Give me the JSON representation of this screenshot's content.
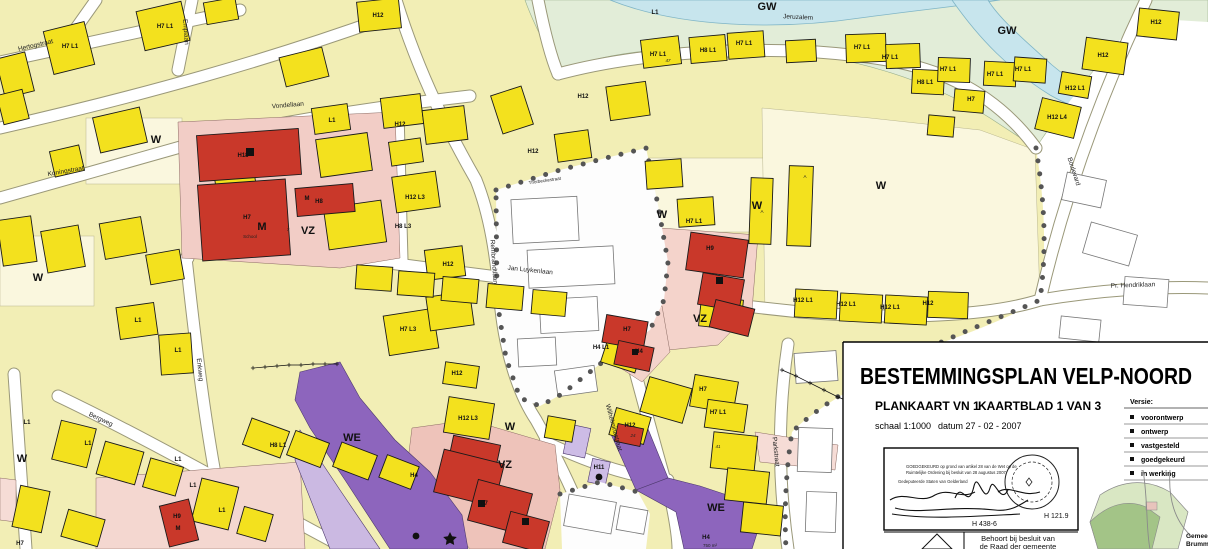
{
  "title_block": {
    "title": "BESTEMMINGSPLAN VELP-NOORD",
    "sheet_label": "PLANKAART VN 1",
    "sheet_number": "KAARTBLAD 1 VAN 3",
    "scale": "schaal 1:1000",
    "date": "datum 27 - 02 - 2007",
    "versions_title": "Versie:",
    "versions": [
      "voorontwerp",
      "ontwerp",
      "vastgesteld",
      "goedgekeurd",
      "in werking"
    ],
    "approval_stamp": {
      "line1": "GOEDGEKEURD op grond van artikel 28 van de Wet op de",
      "line2": "Ruimtelijke Ordening bij besluit van 28 augustus 2007",
      "line3": "Gedeputeerde Staten van Gelderland",
      "ref_left": "H 438-6",
      "ref_right": "H 121.9"
    },
    "council_note_line1": "Behoort bij besluit van",
    "council_note_line2": "de Raad der gemeente",
    "inset_caption_line1": "Gemeente",
    "inset_caption_line2": "Brummen"
  },
  "map": {
    "labels": [
      {
        "t": "W",
        "x": 156,
        "y": 143,
        "k": "zone"
      },
      {
        "t": "W",
        "x": 38,
        "y": 281,
        "k": "zone"
      },
      {
        "t": "W",
        "x": 662,
        "y": 218,
        "k": "zone"
      },
      {
        "t": "W",
        "x": 881,
        "y": 189,
        "k": "zone"
      },
      {
        "t": "W",
        "x": 757,
        "y": 209,
        "k": "zone"
      },
      {
        "t": "W",
        "x": 22,
        "y": 462,
        "k": "zone"
      },
      {
        "t": "W",
        "x": 510,
        "y": 430,
        "k": "zone"
      },
      {
        "t": "VZ",
        "x": 308,
        "y": 234,
        "k": "zone"
      },
      {
        "t": "VZ",
        "x": 700,
        "y": 322,
        "k": "zone"
      },
      {
        "t": "VZ",
        "x": 505,
        "y": 468,
        "k": "zone"
      },
      {
        "t": "WE",
        "x": 352,
        "y": 441,
        "k": "zone"
      },
      {
        "t": "WE",
        "x": 716,
        "y": 511,
        "k": "zone"
      },
      {
        "t": "GW",
        "x": 767,
        "y": 10,
        "k": "zone"
      },
      {
        "t": "GW",
        "x": 1007,
        "y": 34,
        "k": "zone"
      },
      {
        "t": "M",
        "x": 262,
        "y": 230,
        "k": "zone"
      },
      {
        "t": "M",
        "x": 307,
        "y": 200,
        "k": "bldg"
      },
      {
        "t": "M",
        "x": 178,
        "y": 530,
        "k": "bldg"
      },
      {
        "t": "H18",
        "x": 243,
        "y": 157,
        "k": "bldg"
      },
      {
        "t": "H7",
        "x": 247,
        "y": 219,
        "k": "bldg"
      },
      {
        "t": "H8",
        "x": 319,
        "y": 203,
        "k": "bldg"
      },
      {
        "t": "H9",
        "x": 710,
        "y": 250,
        "k": "bldg"
      },
      {
        "t": "H9",
        "x": 177,
        "y": 518,
        "k": "bldg"
      },
      {
        "t": "H7",
        "x": 627,
        "y": 331,
        "k": "bldg"
      },
      {
        "t": "H4",
        "x": 639,
        "y": 353,
        "k": "bldg"
      },
      {
        "t": "H7",
        "x": 484,
        "y": 505,
        "k": "bldg"
      },
      {
        "t": "H4",
        "x": 414,
        "y": 477,
        "k": "bldg"
      },
      {
        "t": "H4",
        "x": 706,
        "y": 539,
        "k": "bldg"
      },
      {
        "t": "H11",
        "x": 599,
        "y": 469,
        "k": "bldg"
      },
      {
        "t": "H4 L1",
        "x": 601,
        "y": 349,
        "k": "bldg"
      },
      {
        "t": "School",
        "x": 250,
        "y": 238,
        "k": "tiny"
      },
      {
        "t": "750 m²",
        "x": 710,
        "y": 547,
        "k": "tiny"
      },
      {
        "t": "Hertogstraat",
        "x": 36,
        "y": 47,
        "r": -13,
        "k": "street"
      },
      {
        "t": "Koningstraat",
        "x": 66,
        "y": 173,
        "r": -10,
        "k": "street"
      },
      {
        "t": "Vondellaan",
        "x": 288,
        "y": 107,
        "r": -5,
        "k": "street"
      },
      {
        "t": "Emplaan",
        "x": 184,
        "y": 32,
        "r": 86,
        "k": "street"
      },
      {
        "t": "Jeruzalem",
        "x": 798,
        "y": 19,
        "r": 3,
        "k": "street"
      },
      {
        "t": "Jan Luykenlaan",
        "x": 530,
        "y": 272,
        "r": 6,
        "k": "street"
      },
      {
        "t": "Rembrandtlaan",
        "x": 492,
        "y": 262,
        "r": 86,
        "k": "street"
      },
      {
        "t": "Enkweg",
        "x": 198,
        "y": 370,
        "r": 84,
        "k": "street"
      },
      {
        "t": "Bergweg",
        "x": 100,
        "y": 421,
        "r": 25,
        "k": "street"
      },
      {
        "t": "Wilhelminastraat",
        "x": 612,
        "y": 428,
        "r": 75,
        "k": "street"
      },
      {
        "t": "Parkstraat",
        "x": 774,
        "y": 452,
        "r": 84,
        "k": "street"
      },
      {
        "t": "Boulevard",
        "x": 1072,
        "y": 172,
        "r": 72,
        "k": "street"
      },
      {
        "t": "Pr. Hendriklaan",
        "x": 1133,
        "y": 287,
        "r": -2,
        "k": "street"
      },
      {
        "t": "Thorbeckestraat",
        "x": 545,
        "y": 182,
        "r": -8,
        "k": "tiny"
      },
      {
        "t": "H7 L1",
        "x": 70,
        "y": 48,
        "k": "bldg"
      },
      {
        "t": "H7 L1",
        "x": 165,
        "y": 28,
        "k": "bldg"
      },
      {
        "t": "H12",
        "x": 378,
        "y": 17,
        "k": "bldg"
      },
      {
        "t": "L1",
        "x": 655,
        "y": 14,
        "k": "bldg"
      },
      {
        "t": "L1",
        "x": 332,
        "y": 122,
        "k": "bldg"
      },
      {
        "t": "H12",
        "x": 400,
        "y": 126,
        "k": "bldg"
      },
      {
        "t": "H12",
        "x": 533,
        "y": 153,
        "k": "bldg"
      },
      {
        "t": "H12",
        "x": 583,
        "y": 98,
        "k": "bldg"
      },
      {
        "t": "H12 L3",
        "x": 415,
        "y": 199,
        "k": "bldg"
      },
      {
        "t": "H8 L3",
        "x": 403,
        "y": 228,
        "k": "bldg"
      },
      {
        "t": "H12",
        "x": 448,
        "y": 266,
        "k": "bldg"
      },
      {
        "t": "H7 L3",
        "x": 408,
        "y": 331,
        "k": "bldg"
      },
      {
        "t": "H7 L1",
        "x": 694,
        "y": 223,
        "k": "bldg"
      },
      {
        "t": "H7 L1",
        "x": 658,
        "y": 56,
        "k": "bldg"
      },
      {
        "t": "H8 L1",
        "x": 708,
        "y": 52,
        "k": "bldg"
      },
      {
        "t": "H7 L1",
        "x": 744,
        "y": 45,
        "k": "bldg"
      },
      {
        "t": "H7 L1",
        "x": 862,
        "y": 49,
        "k": "bldg"
      },
      {
        "t": "H7 L1",
        "x": 890,
        "y": 59,
        "k": "bldg"
      },
      {
        "t": "H8 L1",
        "x": 925,
        "y": 84,
        "k": "bldg"
      },
      {
        "t": "H7 L1",
        "x": 948,
        "y": 71,
        "k": "bldg"
      },
      {
        "t": "H7 L1",
        "x": 995,
        "y": 76,
        "k": "bldg"
      },
      {
        "t": "H7 L1",
        "x": 1023,
        "y": 71,
        "k": "bldg"
      },
      {
        "t": "H7",
        "x": 971,
        "y": 101,
        "k": "bldg"
      },
      {
        "t": "H12",
        "x": 1103,
        "y": 57,
        "k": "bldg"
      },
      {
        "t": "H12",
        "x": 1156,
        "y": 24,
        "k": "bldg"
      },
      {
        "t": "H12 L1",
        "x": 1075,
        "y": 90,
        "k": "bldg"
      },
      {
        "t": "H12 L4",
        "x": 1057,
        "y": 119,
        "k": "bldg"
      },
      {
        "t": "H12 L1",
        "x": 803,
        "y": 302,
        "k": "bldg"
      },
      {
        "t": "H12 L1",
        "x": 846,
        "y": 306,
        "k": "bldg"
      },
      {
        "t": "H12 L1",
        "x": 890,
        "y": 309,
        "k": "bldg"
      },
      {
        "t": "H12",
        "x": 928,
        "y": 305,
        "k": "bldg"
      },
      {
        "t": "L1",
        "x": 138,
        "y": 322,
        "k": "bldg"
      },
      {
        "t": "L1",
        "x": 178,
        "y": 352,
        "k": "bldg"
      },
      {
        "t": "L1",
        "x": 27,
        "y": 424,
        "k": "bldg"
      },
      {
        "t": "L1",
        "x": 88,
        "y": 445,
        "k": "bldg"
      },
      {
        "t": "L1",
        "x": 178,
        "y": 461,
        "k": "bldg"
      },
      {
        "t": "H8 L1",
        "x": 278,
        "y": 447,
        "k": "bldg"
      },
      {
        "t": "L1",
        "x": 193,
        "y": 487,
        "k": "bldg"
      },
      {
        "t": "L1",
        "x": 222,
        "y": 512,
        "k": "bldg"
      },
      {
        "t": "H7",
        "x": 20,
        "y": 545,
        "k": "bldg"
      },
      {
        "t": "H7 L1",
        "x": 718,
        "y": 414,
        "k": "bldg"
      },
      {
        "t": "H7",
        "x": 703,
        "y": 391,
        "k": "bldg"
      },
      {
        "t": "H12",
        "x": 630,
        "y": 427,
        "k": "bldg"
      },
      {
        "t": "H12",
        "x": 457,
        "y": 375,
        "k": "bldg"
      },
      {
        "t": "H12 L3",
        "x": 468,
        "y": 420,
        "k": "bldg"
      },
      {
        "t": "41",
        "x": 718,
        "y": 448,
        "k": "num"
      },
      {
        "t": "47",
        "x": 668,
        "y": 62,
        "k": "num"
      },
      {
        "t": "7",
        "x": 288,
        "y": 231,
        "k": "num"
      },
      {
        "t": "24",
        "x": 633,
        "y": 437,
        "k": "num"
      },
      {
        "t": "A",
        "x": 805,
        "y": 178,
        "k": "tiny"
      },
      {
        "t": "A",
        "x": 762,
        "y": 213,
        "k": "tiny"
      }
    ]
  }
}
